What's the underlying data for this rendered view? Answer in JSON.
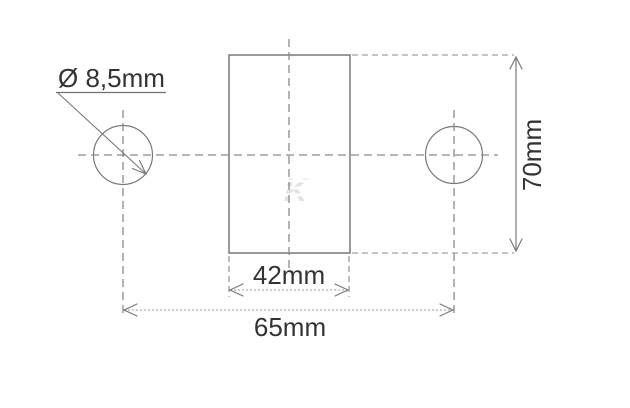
{
  "drawing": {
    "type": "technical-dimension-drawing",
    "background_color": "#ffffff",
    "line_color": "#7a7a7a",
    "text_color": "#333333",
    "watermark_color": "#e2e2e2",
    "labels": {
      "hole_diameter": "Ø 8,5mm",
      "body_width": "42mm",
      "hole_spacing": "65mm",
      "body_height": "70mm"
    },
    "watermark_glyph": "K"
  }
}
